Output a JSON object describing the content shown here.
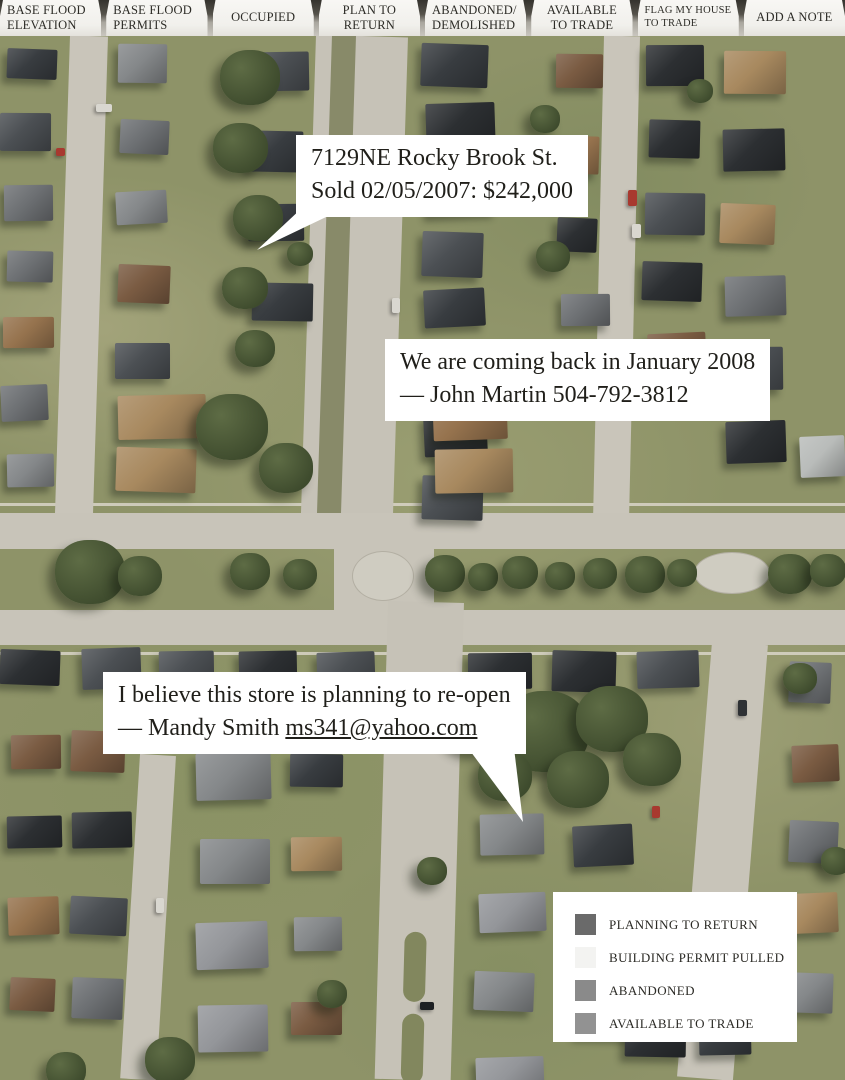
{
  "toolbar": {
    "tabs": [
      {
        "label": "BASE FLOOD\nELEVATION"
      },
      {
        "label": "BASE FLOOD\nPERMITS"
      },
      {
        "label": "OCCUPIED"
      },
      {
        "label": "PLAN TO\nRETURN"
      },
      {
        "label": "ABANDONED/\nDEMOLISHED"
      },
      {
        "label": "AVAILABLE\nTO TRADE"
      },
      {
        "label": "FLAG MY HOUSE\nTO TRADE"
      },
      {
        "label": "ADD A NOTE"
      }
    ]
  },
  "map": {
    "notes": [
      {
        "line1": "7129NE Rocky Brook St.",
        "line2": "Sold 02/05/2007: $242,000"
      },
      {
        "line1": "We are coming back in January 2008",
        "line2": "— John Martin 504-792-3812"
      },
      {
        "line1": "I believe this store is planning to re-open",
        "line2_prefix": "— Mandy Smith ",
        "email": "ms341@yahoo.com"
      }
    ]
  },
  "legend": {
    "items": [
      {
        "label": "PLANNING TO RETURN",
        "color": "#6a6a6a"
      },
      {
        "label": "BUILDING PERMIT PULLED",
        "color": "#f3f3f1"
      },
      {
        "label": "ABANDONED",
        "color": "#8a8a8a"
      },
      {
        "label": "AVAILABLE TO TRADE",
        "color": "#929292"
      }
    ]
  }
}
